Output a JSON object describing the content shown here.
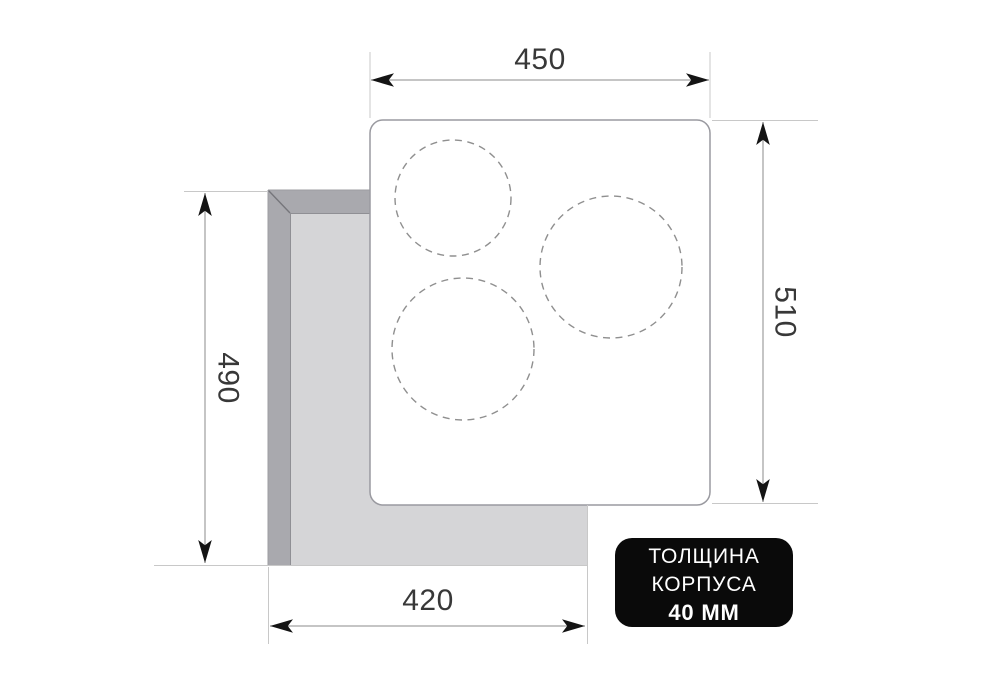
{
  "diagram": {
    "title": "hob-installation-dimensions",
    "dimensions": {
      "top_width": {
        "value": "450"
      },
      "right_height": {
        "value": "510"
      },
      "left_height": {
        "value": "490"
      },
      "bottom_width": {
        "value": "420"
      }
    },
    "badge": {
      "line1": "ТОЛЩИНА",
      "line2": "КОРПУСА",
      "line3": "40 ММ"
    },
    "burners": [
      {
        "cx": 453,
        "cy": 198,
        "r": 58
      },
      {
        "cx": 611,
        "cy": 267,
        "r": 71
      },
      {
        "cx": 463,
        "cy": 349,
        "r": 71
      }
    ],
    "colors": {
      "background": "#ffffff",
      "panel_fill": "#ffffff",
      "panel_border": "#9a9aa0",
      "cutout_frame": "#a9a9ae",
      "cutout_inner": "#d5d5d7",
      "cutout_edge": "#8f8f94",
      "cutout_miter": "#76767b",
      "dimension_text": "#383838",
      "dimension_line": "#8b8b8b",
      "extension_line": "#c8c8c8",
      "arrow": "#141414",
      "burner_dash": "#8f8f8f",
      "badge_bg": "#0a0a0a",
      "badge_text": "#ffffff"
    }
  }
}
